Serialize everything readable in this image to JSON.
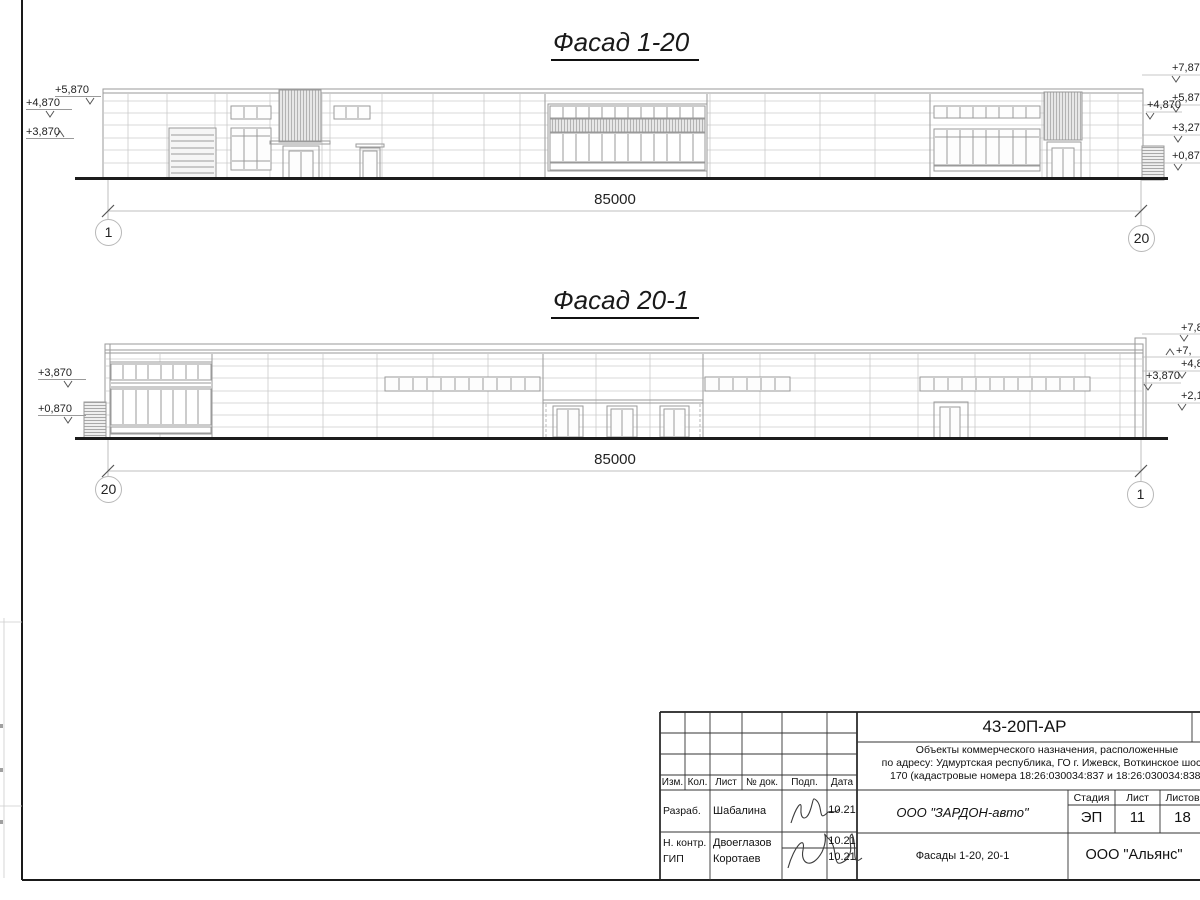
{
  "sheet": {
    "facade_top": {
      "title": "Фасад 1-20",
      "dimension": "85000",
      "axis_left": "1",
      "axis_right": "20",
      "marks_left": [
        "+5,870",
        "+4,870",
        "+3,870"
      ],
      "marks_right": [
        "+7,87",
        "+5,87",
        "+4,870",
        "+3,27",
        "+0,87"
      ]
    },
    "facade_bottom": {
      "title": "Фасад 20-1",
      "dimension": "85000",
      "axis_left": "20",
      "axis_right": "1",
      "marks_left": [
        "+3,870",
        "+0,870"
      ],
      "marks_right": [
        "+7,8",
        "+7,",
        "+4,8",
        "+3,870",
        "+2,1"
      ]
    },
    "title_block": {
      "doc_code": "43-20П-АР",
      "description_line1": "Объекты коммерческого назначения, расположенные",
      "description_line2": "по адресу: Удмуртская республика, ГО г. Ижевск, Воткинское шоссе",
      "description_line3": "170 (кадастровые номера 18:26:030034:837 и 18:26:030034:838)",
      "col_izm": "Изм.",
      "col_kol": "Кол.",
      "col_list": "Лист",
      "col_doc": "№ док.",
      "col_podp": "Подп.",
      "col_data": "Дата",
      "rows": [
        {
          "role": "Разраб.",
          "name": "Шабалина",
          "date": "10.21"
        },
        {
          "role": "Н. контр.",
          "name": "Двоеглазов",
          "date": "10.21"
        },
        {
          "role": "ГИП",
          "name": "Коротаев",
          "date": "10.21"
        }
      ],
      "company": "ООО \"ЗАРДОН-авто\"",
      "stage_label": "Стадия",
      "sheet_label": "Лист",
      "sheets_label": "Листов",
      "stage": "ЭП",
      "sheet_num": "11",
      "sheets_total": "18",
      "sheet_title": "Фасады 1-20, 20-1",
      "org": "ООО \"Альянс\""
    }
  }
}
